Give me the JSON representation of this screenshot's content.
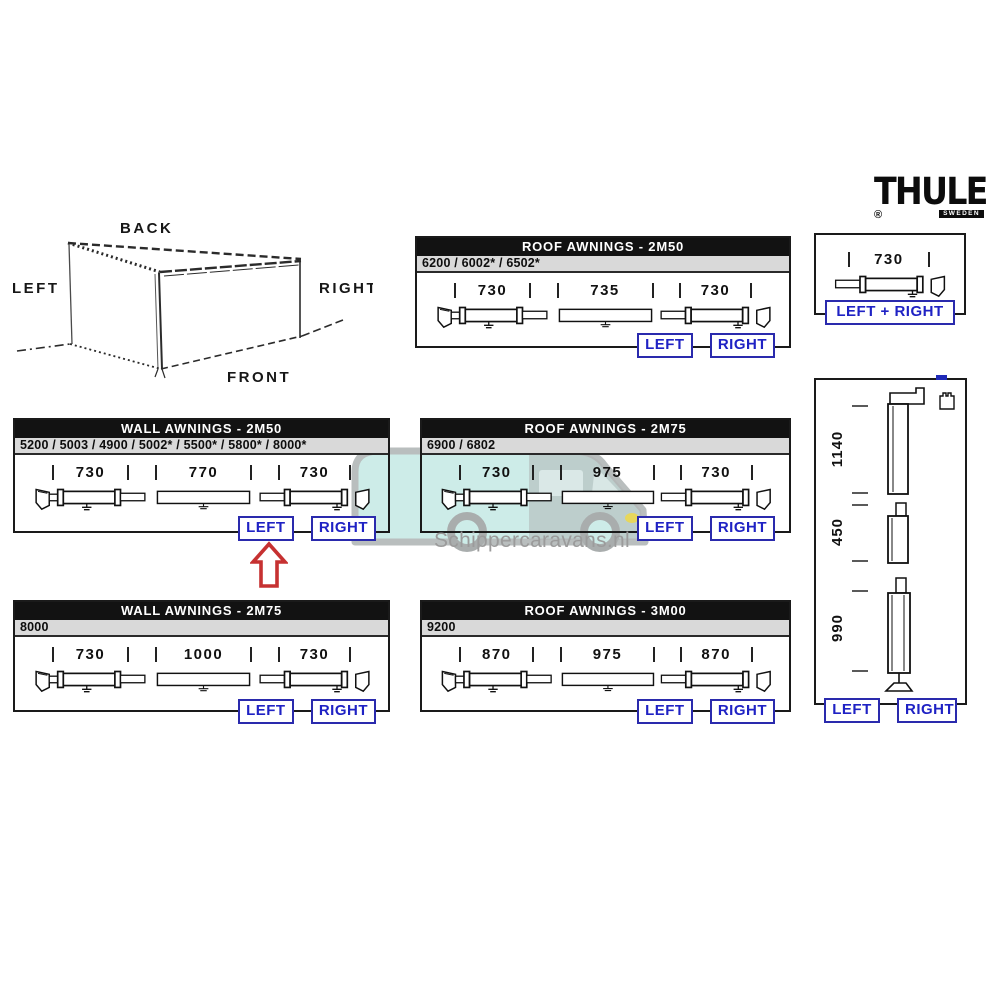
{
  "brand": {
    "name": "THULE",
    "registered": "®",
    "sublabel": "SWEDEN"
  },
  "orientation": {
    "back": "BACK",
    "left": "LEFT",
    "right": "RIGHT",
    "front": "FRONT"
  },
  "watermark": {
    "text": "Schippercaravans.nl"
  },
  "buttons": {
    "left": "LEFT",
    "right": "RIGHT",
    "left_plus_right": "LEFT + RIGHT"
  },
  "colors": {
    "button_blue": "#1f22c4",
    "header_black": "#121212",
    "subheader_gray": "#d9d9d9",
    "arrow_red": "#c63131",
    "watermark_teal": "#c9ebe7"
  },
  "panels": {
    "roof_2m50": {
      "title": "ROOF AWNINGS - 2M50",
      "models": "6200 / 6002* / 6502*",
      "dims": [
        "730",
        "735",
        "730"
      ]
    },
    "spare_single": {
      "dim": "730"
    },
    "wall_2m50": {
      "title": "WALL AWNINGS - 2M50",
      "models": "5200 / 5003 / 4900 / 5002* / 5500* / 5800* / 8000*",
      "dims": [
        "730",
        "770",
        "730"
      ]
    },
    "roof_2m75": {
      "title": "ROOF AWNINGS - 2M75",
      "models": "6900 / 6802",
      "dims": [
        "730",
        "975",
        "730"
      ]
    },
    "vertical_legs": {
      "dims": [
        "1140",
        "450",
        "990"
      ]
    },
    "wall_2m75": {
      "title": "WALL AWNINGS - 2M75",
      "models": "8000",
      "dims": [
        "730",
        "1000",
        "730"
      ]
    },
    "roof_3m00": {
      "title": "ROOF AWNINGS - 3M00",
      "models": "9200",
      "dims": [
        "870",
        "975",
        "870"
      ]
    }
  }
}
